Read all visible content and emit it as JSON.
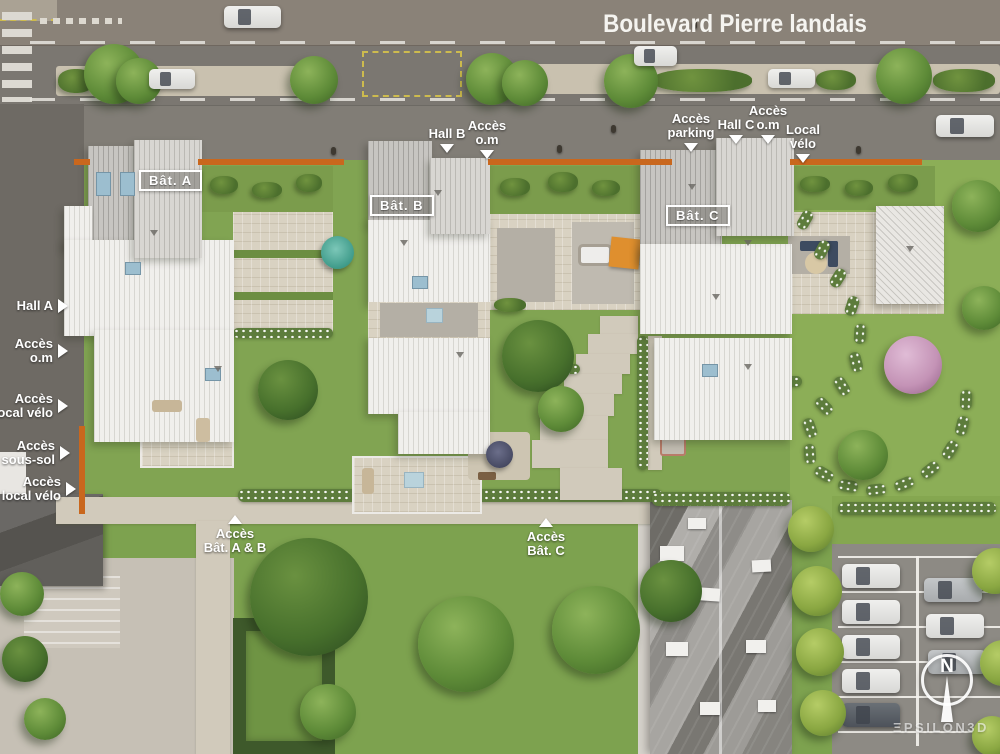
{
  "street": {
    "title": "Boulevard Pierre landais"
  },
  "badges": {
    "bat_a": "Bât. A",
    "bat_b": "Bât. B",
    "bat_c": "Bât. C"
  },
  "labels": {
    "hall_b": {
      "line1": "Hall B"
    },
    "acces_om_top": {
      "line1": "Accès",
      "line2": "o.m"
    },
    "acces_parking": {
      "line1": "Accès",
      "line2": "parking"
    },
    "hall_c": {
      "line1": "Hall C"
    },
    "acces_om_right": {
      "line1": "Accès",
      "line2": "o.m"
    },
    "local_velo": {
      "line1": "Local",
      "line2": "vélo"
    },
    "hall_a": {
      "line1": "Hall A"
    },
    "acces_om_left": {
      "line1": "Accès",
      "line2": "o.m"
    },
    "acces_local_velo_top": {
      "line1": "Accès",
      "line2": "local vélo"
    },
    "acces_sous_sol": {
      "line1": "Accès",
      "line2": "sous-sol"
    },
    "acces_local_velo_bottom": {
      "line1": "Accès",
      "line2": "local vélo"
    },
    "acces_bat_ab": {
      "line1": "Accès",
      "line2": "Bât. A & B"
    },
    "acces_bat_c": {
      "line1": "Accès",
      "line2": "Bât. C"
    }
  },
  "compass": {
    "north": "N"
  },
  "watermark": {
    "brand": "ΞPSILON3D"
  },
  "colors": {
    "accent_orange": "#c9671d",
    "play_square_orange": "#df8f2e",
    "parasol_teal": "#4fae9d"
  }
}
